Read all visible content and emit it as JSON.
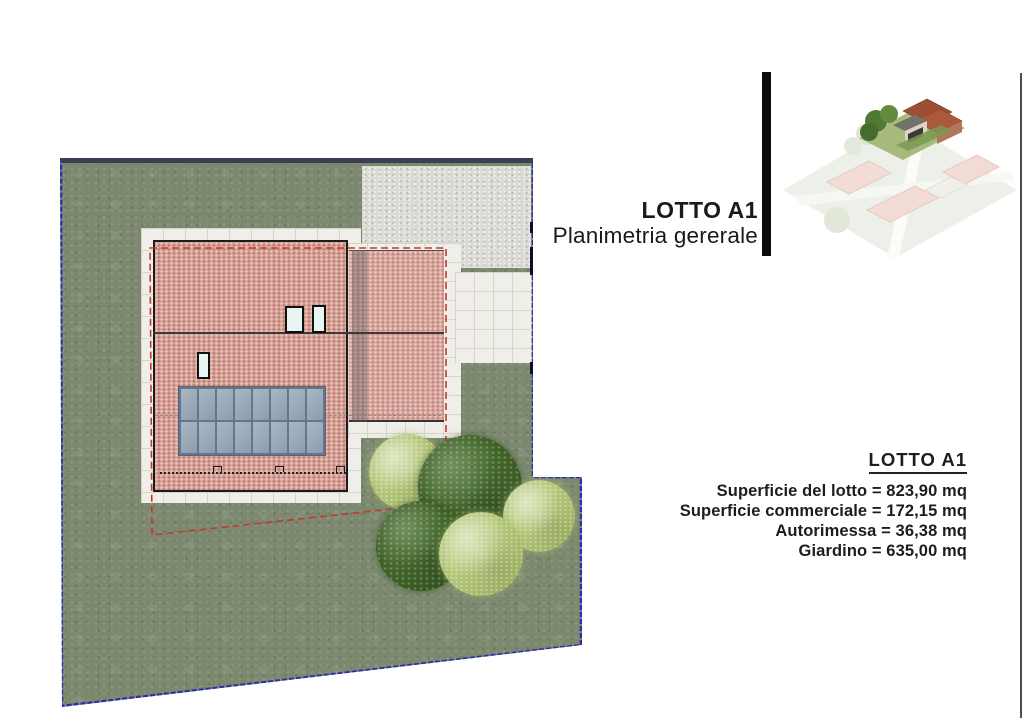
{
  "title_block": {
    "line1": "LOTTO A1",
    "line2": "Planimetria gererale"
  },
  "info_block": {
    "heading": "LOTTO A1",
    "items": [
      "Superficie del lotto = 823,90 mq",
      "Superficie commerciale = 172,15 mq",
      "Autorimessa = 36,38 mq",
      "Giardino = 635,00 mq"
    ]
  },
  "site_plan": {
    "solar_array": {
      "columns": 8,
      "rows": 2
    },
    "colors": {
      "lot_border": "#2a2cb4",
      "grass": "#7c896f",
      "roof_tile": "#d49b90",
      "solar_panel": "#9aa8b8",
      "gravel": "#dadad5",
      "paving": "#efeee9",
      "outline_dashed": "#c2392e"
    }
  }
}
